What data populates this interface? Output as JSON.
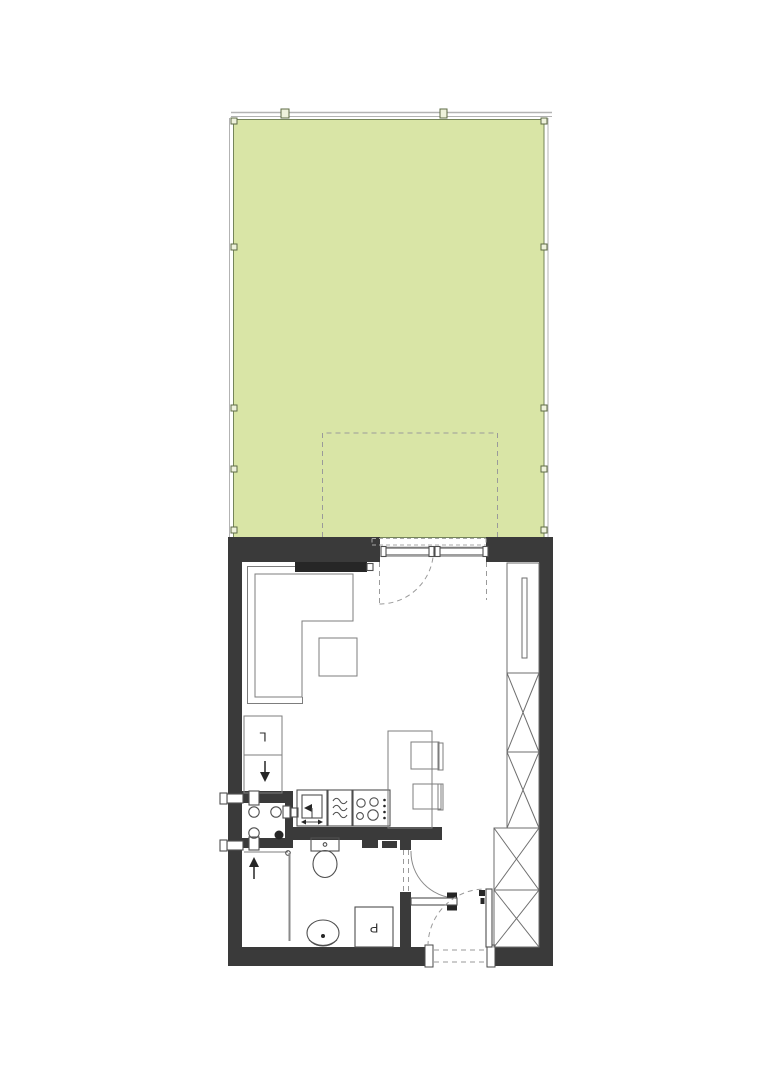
{
  "plan": {
    "type": "studio-apartment-floor-plan-with-garden",
    "labels": {
      "fridge": "L",
      "washing_machine": "P"
    },
    "colors": {
      "wall": "#3a3a3a",
      "lawn_fill": "#d9e5a6",
      "lawn_border": "#75855a",
      "fence": "#b3b3b3",
      "furniture_line": "#7d7d7d",
      "fixture_line": "#4f4f4f",
      "dash_line": "#9a9a9a",
      "accent_black": "#262626"
    }
  }
}
